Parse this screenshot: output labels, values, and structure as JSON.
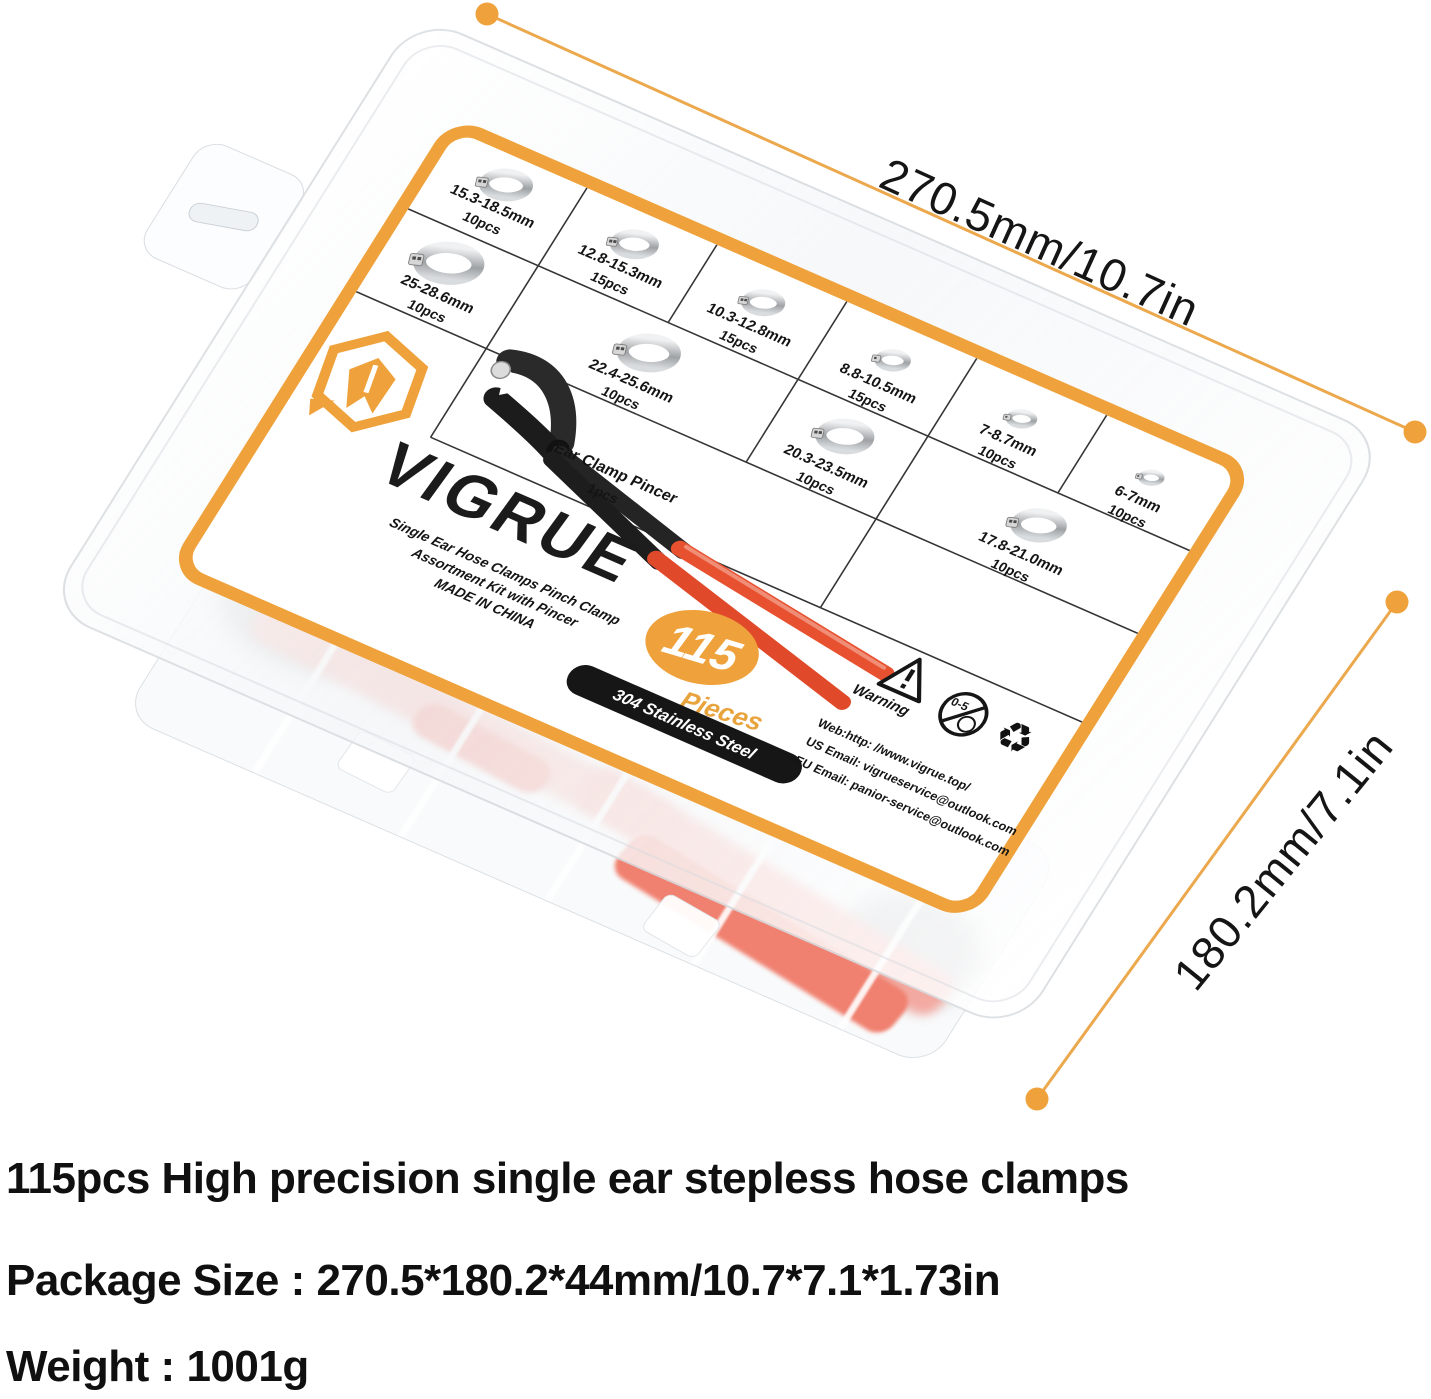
{
  "colors": {
    "accent_orange": "#EFA23B",
    "dim_line_orange": "#ECA84D",
    "pincer_red": "#E8512F",
    "badge_black": "#161616",
    "pink_through_plastic": "#F6B3AA",
    "clamp_silver": "#9EA2A5"
  },
  "dimension_labels": {
    "width": "270.5mm/10.7in",
    "depth": "180.2mm/7.1in"
  },
  "label": {
    "brand": "VIGRUE",
    "subtitle_lines": {
      "0": "Single Ear Hose Clamps Pinch Clamp",
      "1": "Assortment Kit with Pincer",
      "2": "MADE IN CHINA"
    },
    "count": "115",
    "count_word": "Pieces",
    "material": "304 Stainless Steel",
    "cells": [
      {
        "size": "15.3-18.5mm",
        "qty": "10pcs"
      },
      {
        "size": "12.8-15.3mm",
        "qty": "15pcs"
      },
      {
        "size": "10.3-12.8mm",
        "qty": "15pcs"
      },
      {
        "size": "8.8-10.5mm",
        "qty": "15pcs"
      },
      {
        "size": "7-8.7mm",
        "qty": "10pcs"
      },
      {
        "size": "6-7mm",
        "qty": "10pcs"
      },
      {
        "size": "25-28.6mm",
        "qty": "10pcs"
      },
      {
        "size": "22.4-25.6mm",
        "qty": "10pcs"
      },
      {
        "size": "20.3-23.5mm",
        "qty": "10pcs"
      },
      {
        "size": "17.8-21.0mm",
        "qty": "10pcs"
      }
    ],
    "pincer_cell": {
      "name": "Ear Clamp Pincer",
      "qty": "1pcs"
    },
    "warning": {
      "title": "Warning",
      "exclamation": "!",
      "age_range": "0-5",
      "recycle_glyph": "♻",
      "web": "Web:http: //www.vigrue.top/",
      "us_email": "US Email: vigrueservice@outlook.com",
      "eu_email": "EU Email: panior-service@outlook.com"
    }
  },
  "through_plastic": {
    "languages": "Engli\nGerm\nFrenc\nSpani\nJapan"
  },
  "captions": {
    "line1": "115pcs High precision single ear stepless hose clamps",
    "line2": "Package Size : 270.5*180.2*44mm/10.7*7.1*1.73in",
    "line3": "Weight : 1001g"
  }
}
